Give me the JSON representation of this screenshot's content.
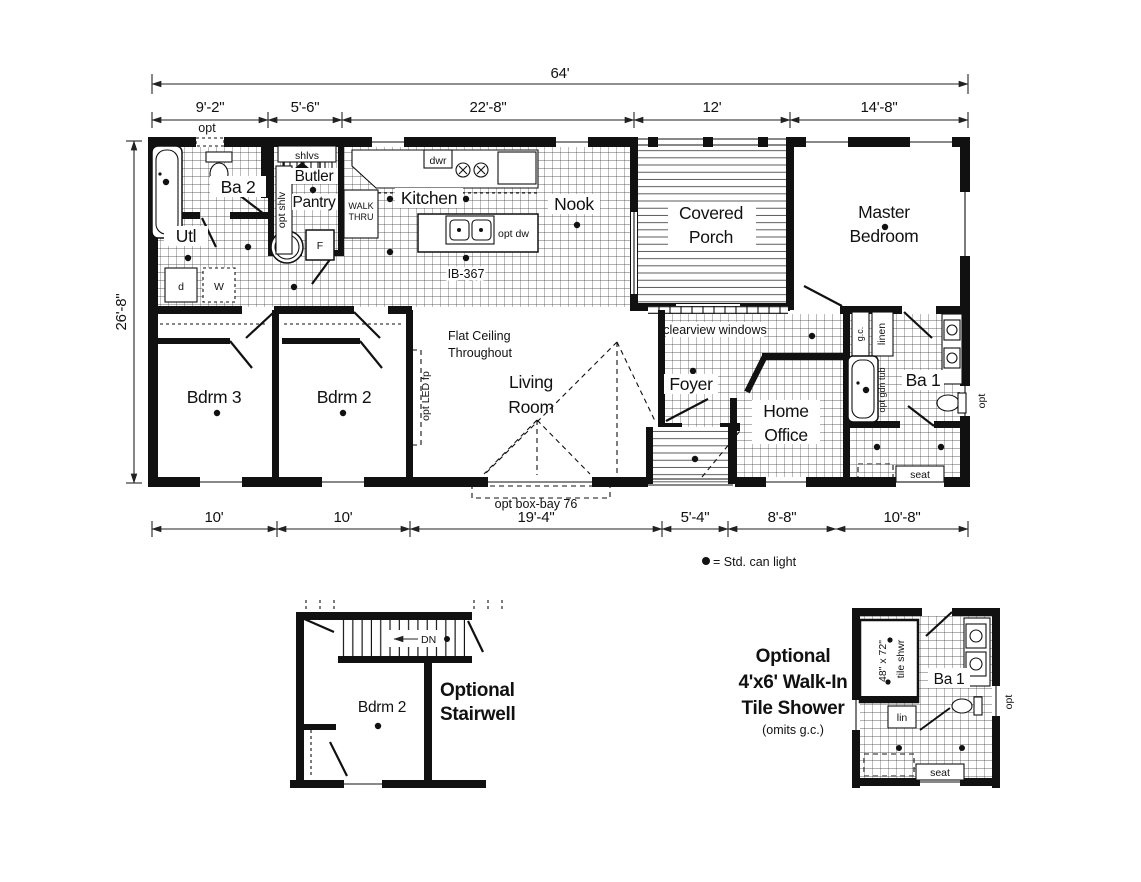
{
  "legend": {
    "text": "= Std. can light"
  },
  "dims": {
    "w": "64'",
    "d": "26'-8\"",
    "top": [
      "9'-2\"",
      "5'-6\"",
      "22'-8\"",
      "12'",
      "14'-8\""
    ],
    "bottom": [
      "10'",
      "10'",
      "19'-4\"",
      "5'-4\"",
      "8'-8\"",
      "10'-8\""
    ]
  },
  "plan": {
    "ba2": "Ba 2",
    "utl": "Utl",
    "butler": [
      "Butler",
      "Pantry"
    ],
    "walkthru": [
      "WALK",
      "THRU"
    ],
    "kitchen": "Kitchen",
    "nook": "Nook",
    "porch": [
      "Covered",
      "Porch"
    ],
    "master": [
      "Master",
      "Bedroom"
    ],
    "bdrm3": "Bdrm 3",
    "bdrm2": "Bdrm 2",
    "living": [
      "Living",
      "Room"
    ],
    "foyer": "Foyer",
    "office": [
      "Home",
      "Office"
    ],
    "ba1": "Ba 1",
    "flat": [
      "Flat Ceiling",
      "Throughout"
    ],
    "opt": "opt",
    "shlvs": "shlvs",
    "opt_shlv": "opt shlv",
    "dwr": "dwr",
    "opt_dw": "opt dw",
    "model": "IB-367",
    "opt_led": "opt LED fp",
    "boxbay": "opt box-bay 76",
    "clearview": "clearview windows",
    "gc": "g.c.",
    "linen": "linen",
    "gdntub": "opt gdn tub",
    "seat": "seat",
    "d": "d",
    "w": "W",
    "f": "F",
    "wh": "WH"
  },
  "stair": {
    "title": [
      "Optional",
      "Stairwell"
    ],
    "bdrm2": "Bdrm 2",
    "dn": "DN"
  },
  "shower": {
    "title": [
      "Optional",
      "4'x6' Walk-In",
      "Tile Shower"
    ],
    "note": "(omits g.c.)",
    "size": "48\" x 72\"",
    "label": "tile shwr",
    "ba1": "Ba 1",
    "lin": "lin",
    "seat": "seat",
    "opt": "opt"
  }
}
